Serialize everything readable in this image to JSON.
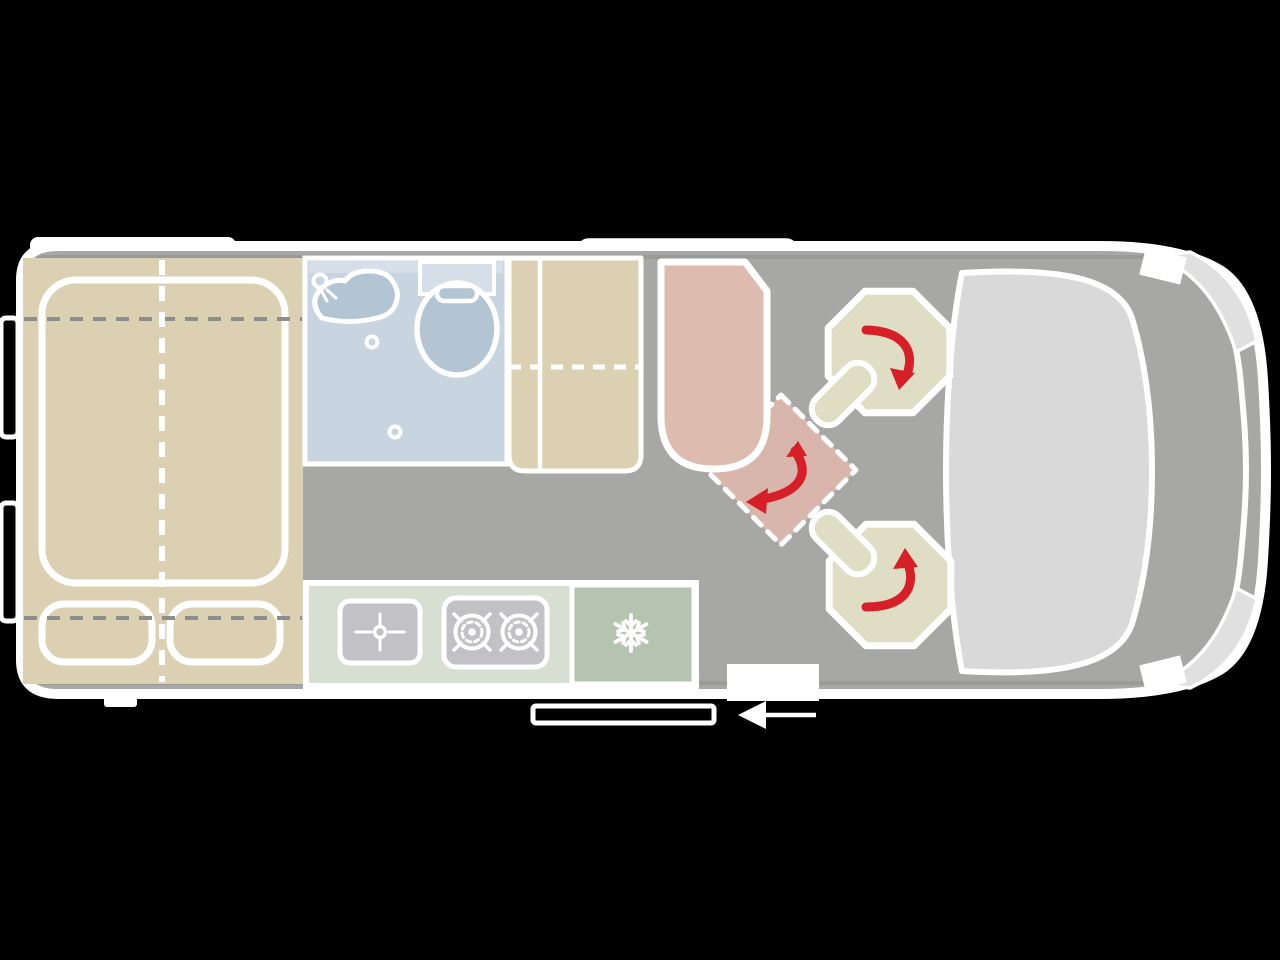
{
  "colors": {
    "bg": "#000000",
    "body_outline": "#ffffff",
    "inner_wall": "#9a9a98",
    "floor": "#a7a7a5",
    "bed": "#dbd0b2",
    "bed_dash": "#8d8d8b",
    "bathroom": "#c8d4df",
    "bathroom_light": "#d6dfe8",
    "fixture": "#b3c5d3",
    "kitchen": "#d7ded2",
    "appliance": "#c2c2c6",
    "fridge": "#b4c4b0",
    "seat": "#dfdec4",
    "bench": "#debbaf",
    "table": "#d9b6ab",
    "glass": "#d9d9d9",
    "band_light": "#e0e0e0",
    "arrow_red": "#d71f27"
  },
  "zones": [
    {
      "name": "rear-double-bed",
      "features": [
        "mattress",
        "pillow-left",
        "pillow-right",
        "center-fold-dashed-line",
        "head-dashed-line",
        "foot-dashed-line"
      ]
    },
    {
      "name": "bathroom",
      "fixtures": [
        "washbasin",
        "toilet",
        "drain",
        "shower-drain"
      ]
    },
    {
      "name": "wardrobe",
      "features": [
        "shelf-divider",
        "dashed-split-line"
      ]
    },
    {
      "name": "kitchen",
      "appliances": [
        "sink",
        "two-burner-hob",
        "refrigerator"
      ]
    },
    {
      "name": "lounge",
      "items": [
        "bench-seat",
        "removable-table",
        "swivel-seat-driver",
        "swivel-seat-passenger"
      ]
    },
    {
      "name": "cab",
      "items": [
        "windshield-dashboard",
        "hood",
        "front-bumper",
        "mirror-left",
        "mirror-right"
      ]
    }
  ],
  "icons": [
    {
      "name": "snowflake-icon",
      "meaning": "refrigerator"
    },
    {
      "name": "burner-icon",
      "meaning": "gas hob ring"
    },
    {
      "name": "faucet-crosshair-icon",
      "meaning": "kitchen sink tap"
    },
    {
      "name": "rotation-arrow-icon",
      "meaning": "seat/table swivels"
    },
    {
      "name": "entry-arrow-icon",
      "meaning": "entrance direction through sliding door"
    }
  ]
}
